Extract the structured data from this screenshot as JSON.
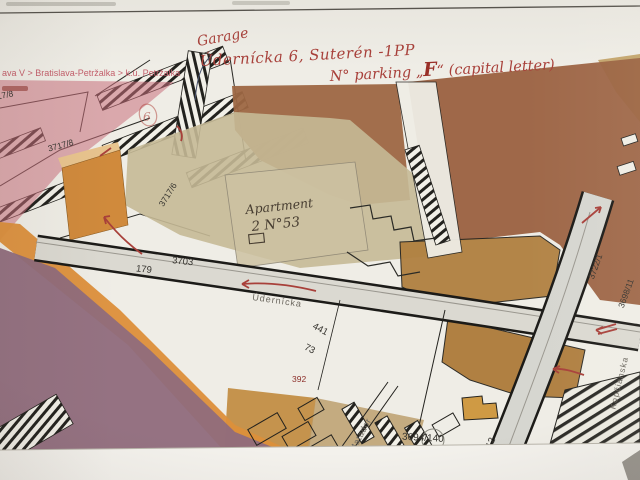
{
  "breadcrumb": {
    "text": "ava V > Bratislava-Petržalka > k.ú. Petržalka"
  },
  "handwriting": {
    "garage": "Garage",
    "address": "Údernícka 6, Suterén -1PP",
    "parking_prefix": "N° parking „",
    "parking_letter": "F",
    "parking_suffix": "“ (capital letter)",
    "apartment": "Apartment",
    "apartment_no": "2 N°53",
    "circled_digit": "6"
  },
  "map": {
    "streets": {
      "udernicka": "Údernícka",
      "kopcianska": "Kopčianska",
      "matador": "Matador"
    },
    "parcels": {
      "a": "3717/8",
      "b": "3717/8",
      "c": "3717/6",
      "d": "3703",
      "e": "179",
      "f": "441",
      "g": "73",
      "h": "392",
      "i": "3722/1",
      "j": "3698/11",
      "k": "3694/140",
      "l": "4/12"
    }
  },
  "colors": {
    "pink_zone": "#c96f7c",
    "mauve_zone": "#8f6c7c",
    "orange_zone": "#dc8f3a",
    "terracotta_zone": "#9a6140",
    "ochre_zone": "#b08040",
    "tan_zone": "#c5b996",
    "annotation_red": "#a8403a"
  }
}
